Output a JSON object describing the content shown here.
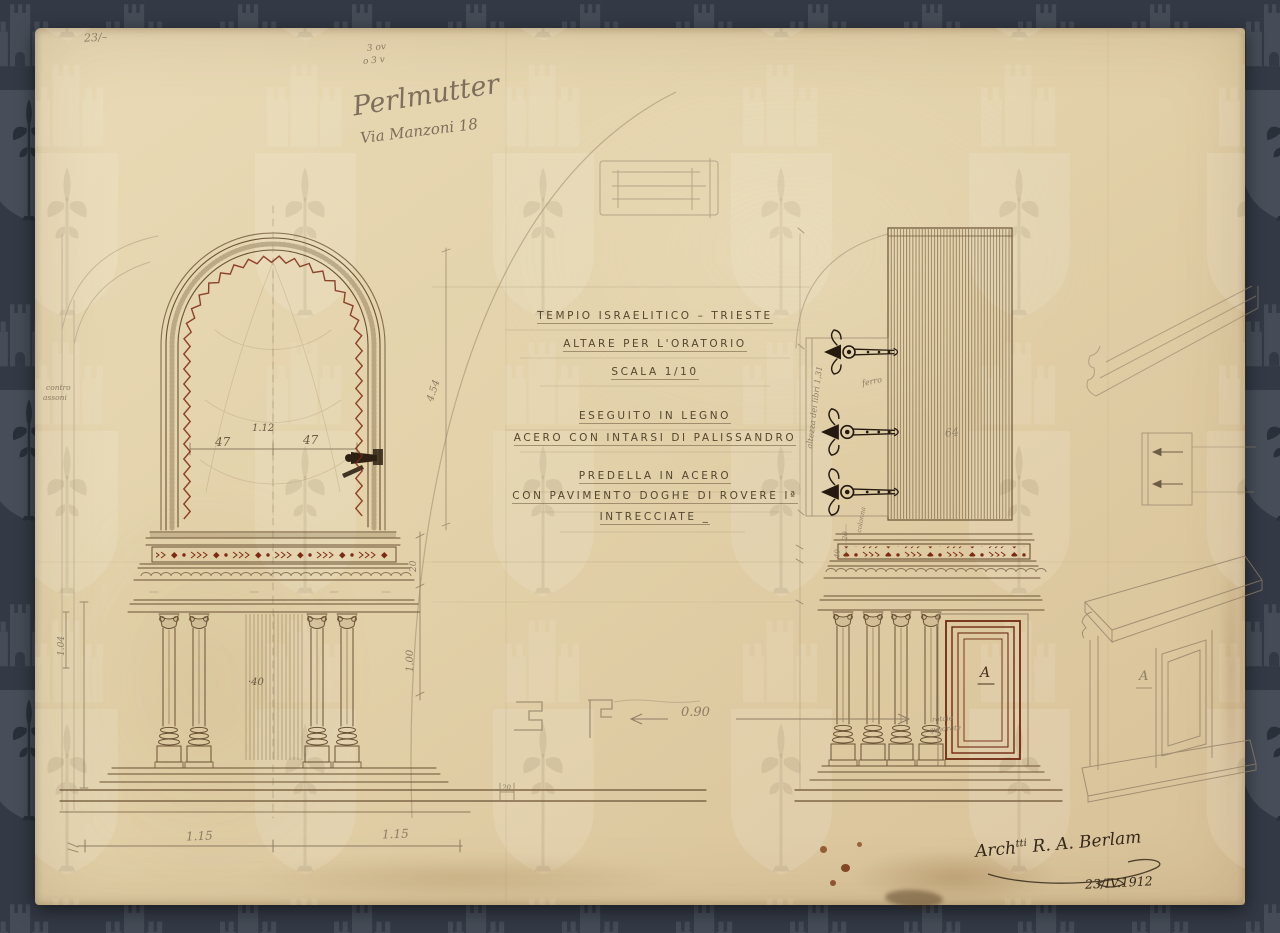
{
  "title_block": {
    "lines": [
      "TEMPIO ISRAELITICO – TRIESTE",
      "ALTARE PER L'ORATORIO",
      "SCALA 1/10",
      "ESEGUITO IN LEGNO",
      "ACERO CON INTARSI DI PALISSANDRO",
      "PREDELLA IN ACERO",
      "CON PAVIMENTO DOGHE DI ROVERE Iª",
      "INTRECCIATE _"
    ]
  },
  "pencil_notes": {
    "archive_number": "23/–",
    "scribble_top_1": "3 ov",
    "scribble_top_2": "o 3 v",
    "client_name": "Perlmutter",
    "client_address": "Via Manzoni 18",
    "margin_note_line1": "contro",
    "margin_note_line2": "assoni",
    "hinge_height_note": "altezza dei libri 1,31",
    "hinge_material_note": "ferro",
    "predella_note_line1": "rotaie",
    "predella_note_line2": "quadrate",
    "column_note": "colonna"
  },
  "dimensions": {
    "window_half_left": "47",
    "window_half_right": "47",
    "window_top": "1.12",
    "arch_height": "4.54",
    "frieze_height": "20",
    "predella_height": "1.00",
    "table_depth": "·40",
    "left_edge_height": "1.04",
    "bay_left": "1.15",
    "bay_right": "1.15",
    "predella_width": "0.90",
    "step_detail": "20",
    "curtain_width": "64",
    "right_small_a": "20",
    "right_small_b": "40"
  },
  "labels": {
    "panel_letter": "A",
    "sketch_letter": "A"
  },
  "signature": {
    "prefix": "Arch",
    "sup": "tti",
    "name": "R. A. Berlam",
    "date": "23/IV.1912"
  },
  "colors": {
    "background": "#333945",
    "watermark": "#47(4e)59",
    "paper": "#e3d2aa",
    "ink": "#6a5234",
    "pencil": "#8d7c64",
    "inlay_red": "#7c2a12"
  }
}
